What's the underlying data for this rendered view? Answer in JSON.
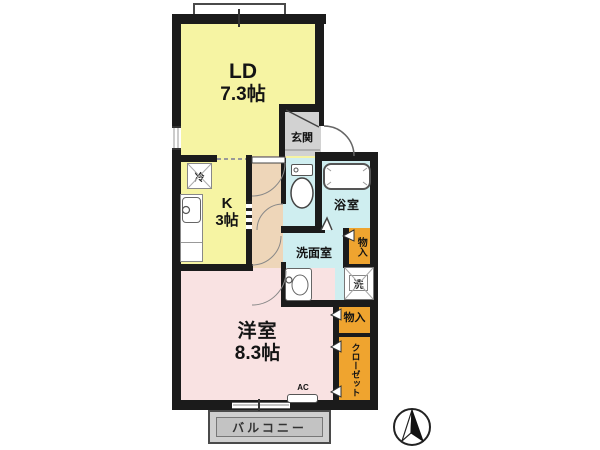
{
  "plan_type": "apartment-floor-plan",
  "rooms": {
    "ld": {
      "name": "LD",
      "size": "7.3帖"
    },
    "kitchen": {
      "name": "K",
      "size": "3帖"
    },
    "western": {
      "name": "洋室",
      "size": "8.3帖"
    },
    "entrance": {
      "label": "玄関"
    },
    "bathroom": {
      "label": "浴室"
    },
    "washroom": {
      "label": "洗面室"
    }
  },
  "storage": {
    "upper_monoire": {
      "label": "物入"
    },
    "lower_monoire": {
      "label": "物入"
    },
    "closet": {
      "label": "クローゼット"
    }
  },
  "fixtures": {
    "refrigerator_space": {
      "label": "冷"
    },
    "washer_space": {
      "label": "洗"
    },
    "air_conditioner": {
      "label": "AC"
    }
  },
  "balcony": {
    "label": "バルコニー"
  },
  "compass": {
    "type": "north-arrow",
    "direction": "up"
  },
  "colors": {
    "room_yellow": "#f6f4a3",
    "room_pink": "#f9e2e2",
    "hall_tan": "#eed6b9",
    "wet_blue": "#cfeef0",
    "entrance_gray": "#d2d2d2",
    "storage_orange": "#efa42f",
    "balcony_gray": "#cfcfcf",
    "wall_black": "#1b1b1b"
  }
}
